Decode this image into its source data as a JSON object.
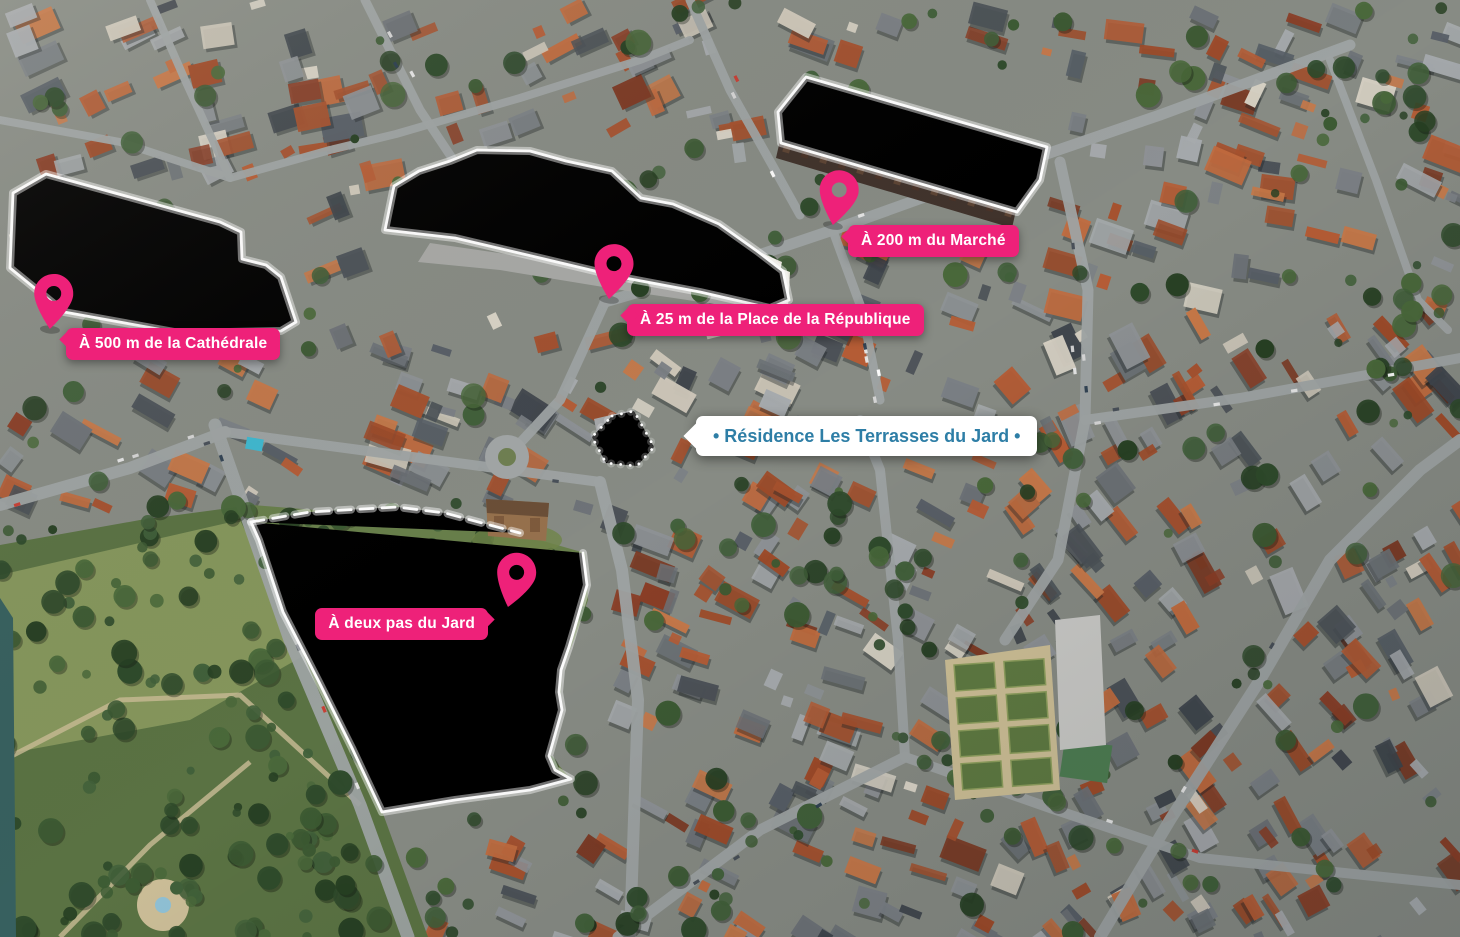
{
  "map": {
    "type": "aerial-promo-map",
    "residence": {
      "name_label": "• Résidence Les Terrasses du Jard •",
      "text_color": "#2E7EA6",
      "bg_color": "#FFFFFF"
    },
    "markers": [
      {
        "id": "cathedrale",
        "label": "À 500 m de la Cathédrale"
      },
      {
        "id": "place-republique",
        "label": "À 25 m de la Place de la République"
      },
      {
        "id": "marche",
        "label": "À 200 m du Marché"
      },
      {
        "id": "jard",
        "label": "À deux pas du Jard"
      }
    ],
    "icons": [
      {
        "name": "map-pin-icon",
        "count": 4
      }
    ],
    "colors": {
      "marker_pink": "#EE2179",
      "marker_label_text": "#FFFFFF",
      "highlight_outline": "#FFFFFF",
      "market_skylight": "#7FD9E2"
    }
  }
}
